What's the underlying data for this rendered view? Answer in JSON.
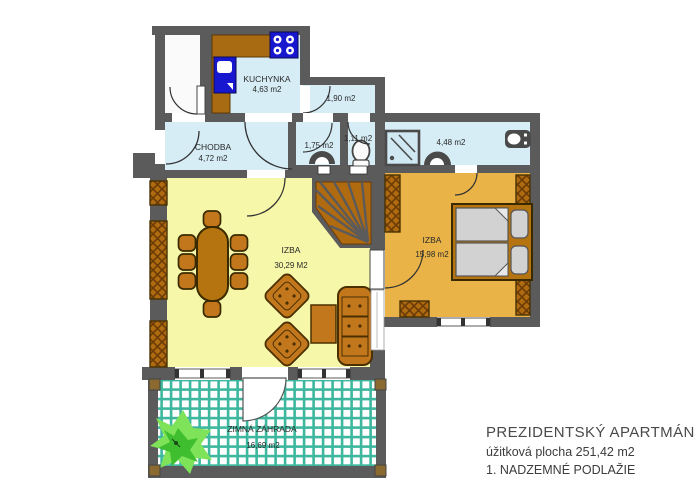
{
  "plan": {
    "rooms": {
      "kitchen": {
        "label": "KUCHYNKA",
        "area": "4,63 m2"
      },
      "pantry": {
        "area": "1,90 m2"
      },
      "hallway": {
        "label": "CHODBA",
        "area": "4,72 m2"
      },
      "wc1": {
        "area": "1,75 m2"
      },
      "wc2": {
        "area": "1,11 m2"
      },
      "bathroom": {
        "area": "4,48 m2"
      },
      "living_room": {
        "label": "IZBA",
        "area": "30,29 M2"
      },
      "bedroom": {
        "label": "IZBA",
        "area": "15,98 m2"
      },
      "winter_garden": {
        "label": "ZIMNÁ ZÁHRADA",
        "area": "16,69 m2"
      }
    },
    "colors": {
      "wall": "#5b5b5b",
      "floor_wet_rooms": "#d6edf6",
      "floor_living": "#f7f7a9",
      "floor_bedroom": "#e9b347",
      "furniture_brown": "#c2771c",
      "counter_brown": "#a96b12",
      "appliance_blue": "#1717d0",
      "tile_teal": "#3db79d",
      "plant_green_light": "#7fe35a",
      "plant_green_dark": "#3fbf2f",
      "mattress_grey": "#d2d2d2"
    },
    "icons": {
      "stove-icon": "four burner rings",
      "fridge-icon": "blue fridge unit",
      "toilet-icon": "oval wc bowl",
      "washbasin-icon": "semicircle basin",
      "shower-icon": "square tray with drain lines",
      "sink-icon": "counter sink oval",
      "plant-icon": "green potted plant"
    }
  },
  "title_block": {
    "title": "PREZIDENTSKÝ APARTMÁN",
    "subtitle": "úžitková plocha 251,42 m2",
    "floor": "1. NADZEMNÉ PODLAŽIE"
  }
}
